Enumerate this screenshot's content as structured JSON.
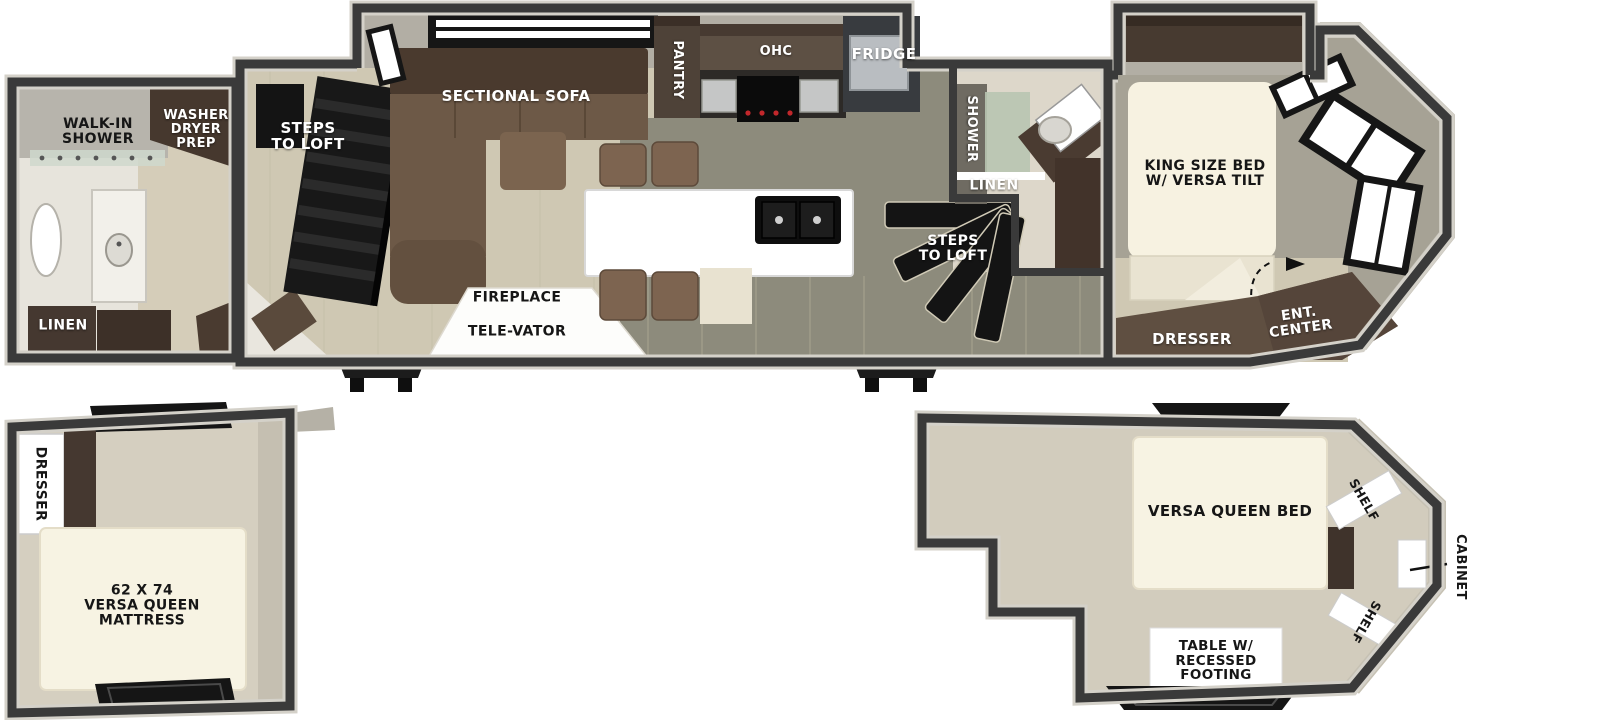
{
  "colors": {
    "wall": "#3a3a3a",
    "floor_beige": "#cfc8b3",
    "floor_olive": "#8d8b7c",
    "cream_mattress": "#f7f2e1",
    "cabinet_brown": "#46382e",
    "stairs_black": "#151515"
  },
  "main_floor": {
    "rear_bath": {
      "walk_in_shower": "WALK-IN\nSHOWER",
      "washer_dryer_prep": "WASHER\nDRYER\nPREP",
      "linen": "LINEN"
    },
    "living": {
      "steps_to_loft": "STEPS\nTO LOFT",
      "sectional_sofa": "SECTIONAL SOFA",
      "fireplace": "FIREPLACE",
      "tele_vator": "TELE-VATOR"
    },
    "kitchen": {
      "pantry": "PANTRY",
      "ohc": "OHC",
      "fridge": "FRIDGE"
    },
    "mid_bath": {
      "shower": "SHOWER",
      "linen": "LINEN"
    },
    "front_steps": {
      "steps_to_loft": "STEPS\nTO LOFT"
    },
    "bedroom": {
      "king_bed": "KING SIZE BED\nW/ VERSA TILT",
      "dresser": "DRESSER",
      "ent_center": "ENT.\nCENTER"
    }
  },
  "rear_loft": {
    "dresser": "DRESSER",
    "mattress": "62 X 74\nVERSA QUEEN\nMATTRESS"
  },
  "front_loft": {
    "bed": "VERSA QUEEN BED",
    "shelf_top": "SHELF",
    "shelf_bottom": "SHELF",
    "cabinet": "CABINET",
    "table": "TABLE W/\nRECESSED\nFOOTING"
  }
}
